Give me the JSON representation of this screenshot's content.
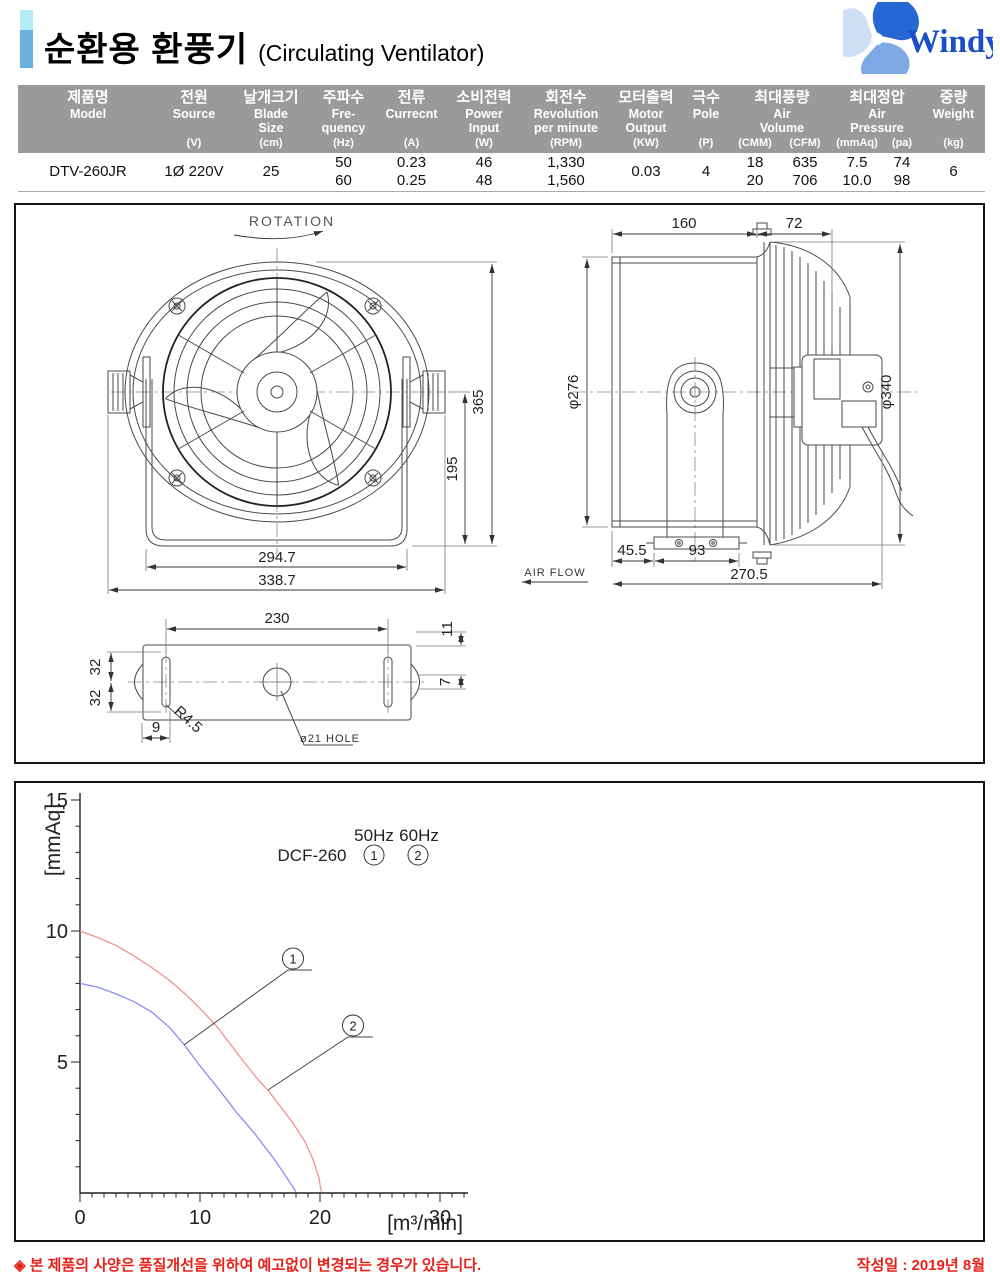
{
  "header": {
    "title_ko": "순환용 환풍기",
    "title_en": "(Circulating Ventilator)",
    "logo": "Windy"
  },
  "spec_table": {
    "columns": [
      {
        "ko": "제품명",
        "en": [
          "Model"
        ],
        "units": [
          ""
        ]
      },
      {
        "ko": "전원",
        "en": [
          "Source"
        ],
        "units": [
          "(V)"
        ]
      },
      {
        "ko": "날개크기",
        "en": [
          "Blade",
          "Size"
        ],
        "units": [
          "(cm)"
        ]
      },
      {
        "ko": "주파수",
        "en": [
          "Fre-",
          "quency"
        ],
        "units": [
          "(Hz)"
        ]
      },
      {
        "ko": "전류",
        "en": [
          "Currecnt"
        ],
        "units": [
          "(A)"
        ]
      },
      {
        "ko": "소비전력",
        "en": [
          "Power",
          "Input"
        ],
        "units": [
          "(W)"
        ]
      },
      {
        "ko": "회전수",
        "en": [
          "Revolution",
          "per minute"
        ],
        "units": [
          "(RPM)"
        ]
      },
      {
        "ko": "모터출력",
        "en": [
          "Motor",
          "Output"
        ],
        "units": [
          "(KW)"
        ]
      },
      {
        "ko": "극수",
        "en": [
          "Pole"
        ],
        "units": [
          "(P)"
        ]
      },
      {
        "ko": "최대풍량",
        "en": [
          "Air",
          "Volume"
        ],
        "units": [
          "(CMM)",
          "(CFM)"
        ]
      },
      {
        "ko": "최대정압",
        "en": [
          "Air",
          "Pressure"
        ],
        "units": [
          "(mmAq)",
          "(pa)"
        ]
      },
      {
        "ko": "중량",
        "en": [
          "Weight"
        ],
        "units": [
          "(kg)"
        ]
      }
    ],
    "row": {
      "model": "DTV-260JR",
      "source": "1Ø 220V",
      "blade_size": "25",
      "frequency": [
        "50",
        "60"
      ],
      "current": [
        "0.23",
        "0.25"
      ],
      "power_input": [
        "46",
        "48"
      ],
      "rpm": [
        "1,330",
        "1,560"
      ],
      "motor_output": "0.03",
      "pole": "4",
      "air_volume_cmm": [
        "18",
        "20"
      ],
      "air_volume_cfm": [
        "635",
        "706"
      ],
      "air_pressure_mmaq": [
        "7.5",
        "10.0"
      ],
      "air_pressure_pa": [
        "74",
        "98"
      ],
      "weight": "6"
    }
  },
  "drawing": {
    "rotation_label": "ROTATION",
    "front": {
      "dim_height": "365",
      "dim_center": "195",
      "dim_inner_width": "294.7",
      "dim_outer_width": "338.7"
    },
    "side": {
      "dim_depth": "160",
      "dim_guard": "72",
      "dia_duct": "φ276",
      "dia_guard": "φ340",
      "dim_foot_offset": "45.5",
      "dim_foot": "93",
      "dim_total": "270.5",
      "air_flow_label": "AIR FLOW"
    },
    "base": {
      "dim_holes": "230",
      "dim_half_a": "32",
      "dim_half_b": "32",
      "dim_slot": "9",
      "dim_edge": "11",
      "dim_tab": "7",
      "radius_label": "R4.5",
      "hole_label": "ø21 HOLE"
    }
  },
  "chart_data": {
    "type": "line",
    "xlabel": "[m³/min]",
    "ylabel": "[mmAq]",
    "xlim": [
      0,
      32
    ],
    "ylim": [
      0,
      15
    ],
    "xticks": [
      0,
      10,
      20,
      30
    ],
    "yticks": [
      5,
      10,
      15
    ],
    "minor_step_x": 1,
    "minor_step_y": 1,
    "grid": false,
    "legend": {
      "model": "DCF-260",
      "freq_labels": [
        "50Hz",
        "60Hz"
      ],
      "position": "top-right"
    },
    "series": [
      {
        "name": "50Hz",
        "mark": "1",
        "color": "#8c8cf0",
        "points": [
          [
            0,
            8
          ],
          [
            1.5,
            7.85
          ],
          [
            3,
            7.6
          ],
          [
            4.5,
            7.3
          ],
          [
            6,
            6.9
          ],
          [
            7.5,
            6.3
          ],
          [
            8.7,
            5.65
          ],
          [
            10,
            4.85
          ],
          [
            11.5,
            4.0
          ],
          [
            13,
            3.1
          ],
          [
            14.5,
            2.3
          ],
          [
            16,
            1.4
          ],
          [
            17,
            0.75
          ],
          [
            18,
            0.05
          ]
        ]
      },
      {
        "name": "60Hz",
        "mark": "2",
        "color": "#f09393",
        "points": [
          [
            0,
            10
          ],
          [
            1.5,
            9.75
          ],
          [
            3,
            9.45
          ],
          [
            4.5,
            9.05
          ],
          [
            6,
            8.6
          ],
          [
            7.5,
            8.1
          ],
          [
            9,
            7.5
          ],
          [
            10.3,
            6.9
          ],
          [
            11.5,
            6.3
          ],
          [
            12.5,
            5.7
          ],
          [
            13.5,
            5.1
          ],
          [
            14.7,
            4.4
          ],
          [
            15.7,
            3.9
          ],
          [
            16.7,
            3.3
          ],
          [
            17.7,
            2.7
          ],
          [
            18.7,
            2.0
          ],
          [
            19.4,
            1.3
          ],
          [
            19.9,
            0.6
          ],
          [
            20.1,
            0.05
          ]
        ]
      }
    ]
  },
  "footer": {
    "note": "◈ 본 제품의 사양은 품질개선을 위하여 예고없이 변경되는 경우가 있습니다.",
    "date": "작성일 : 2019년 8월"
  }
}
